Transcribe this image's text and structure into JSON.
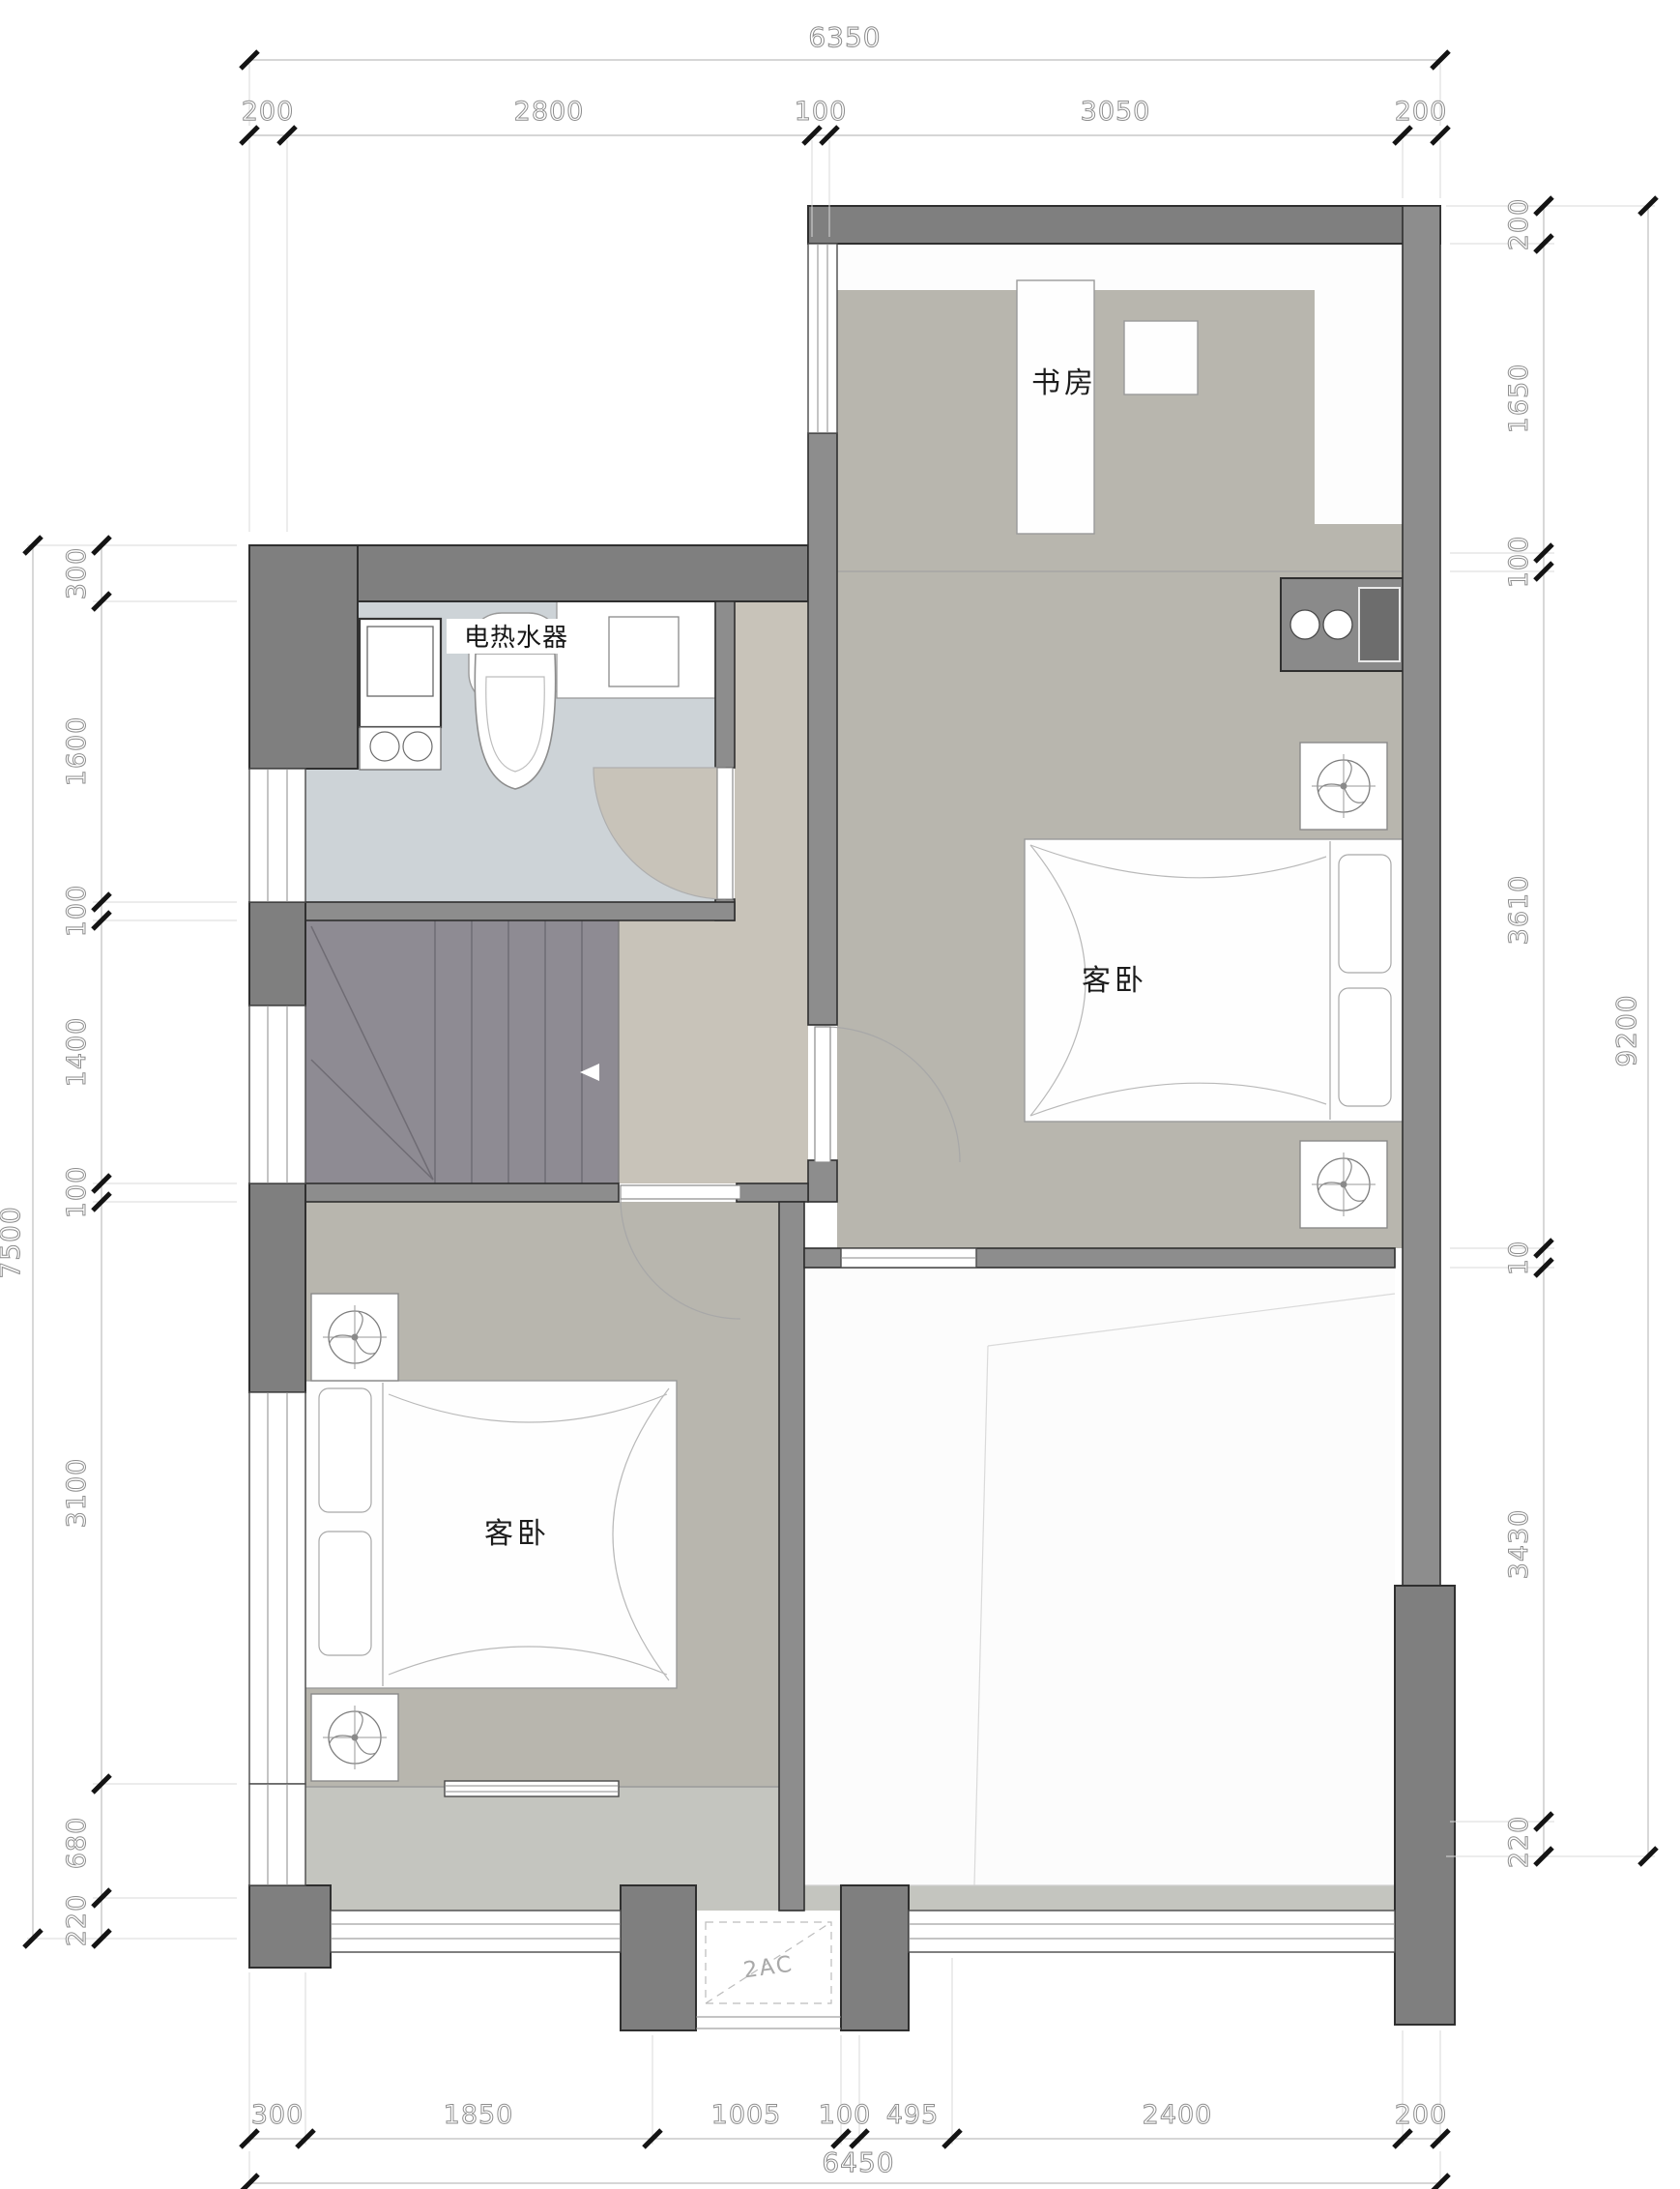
{
  "plan": {
    "rooms": {
      "study": "书房",
      "bedroom_right": "客卧",
      "bedroom_left": "客卧"
    },
    "fixtures": {
      "water_heater": "电热水器",
      "ac_platform": "2AC"
    }
  },
  "dimensions": {
    "top": {
      "overall": "6350",
      "segments": [
        "200",
        "2800",
        "100",
        "3050",
        "200"
      ]
    },
    "bottom": {
      "overall": "6450",
      "segments": [
        "300",
        "1850",
        "1005",
        "100",
        "495",
        "2400",
        "200"
      ]
    },
    "left": {
      "overall": "7500",
      "segments": [
        "300",
        "1600",
        "100",
        "1400",
        "100",
        "3100",
        "680",
        "220"
      ]
    },
    "right": {
      "overall": "9200",
      "segments": [
        "200",
        "1650",
        "100",
        "3610",
        "10",
        "3430",
        "220"
      ]
    }
  },
  "colors": {
    "wall": "#7f7f7f",
    "floor_gray": "#b8b6ae",
    "bathroom": "#cdd3d7",
    "hall": "#c8c3b9",
    "stairs": "#8e8b93",
    "balcony": "#c4c5bf",
    "dim_text": "#8e8e8e"
  }
}
